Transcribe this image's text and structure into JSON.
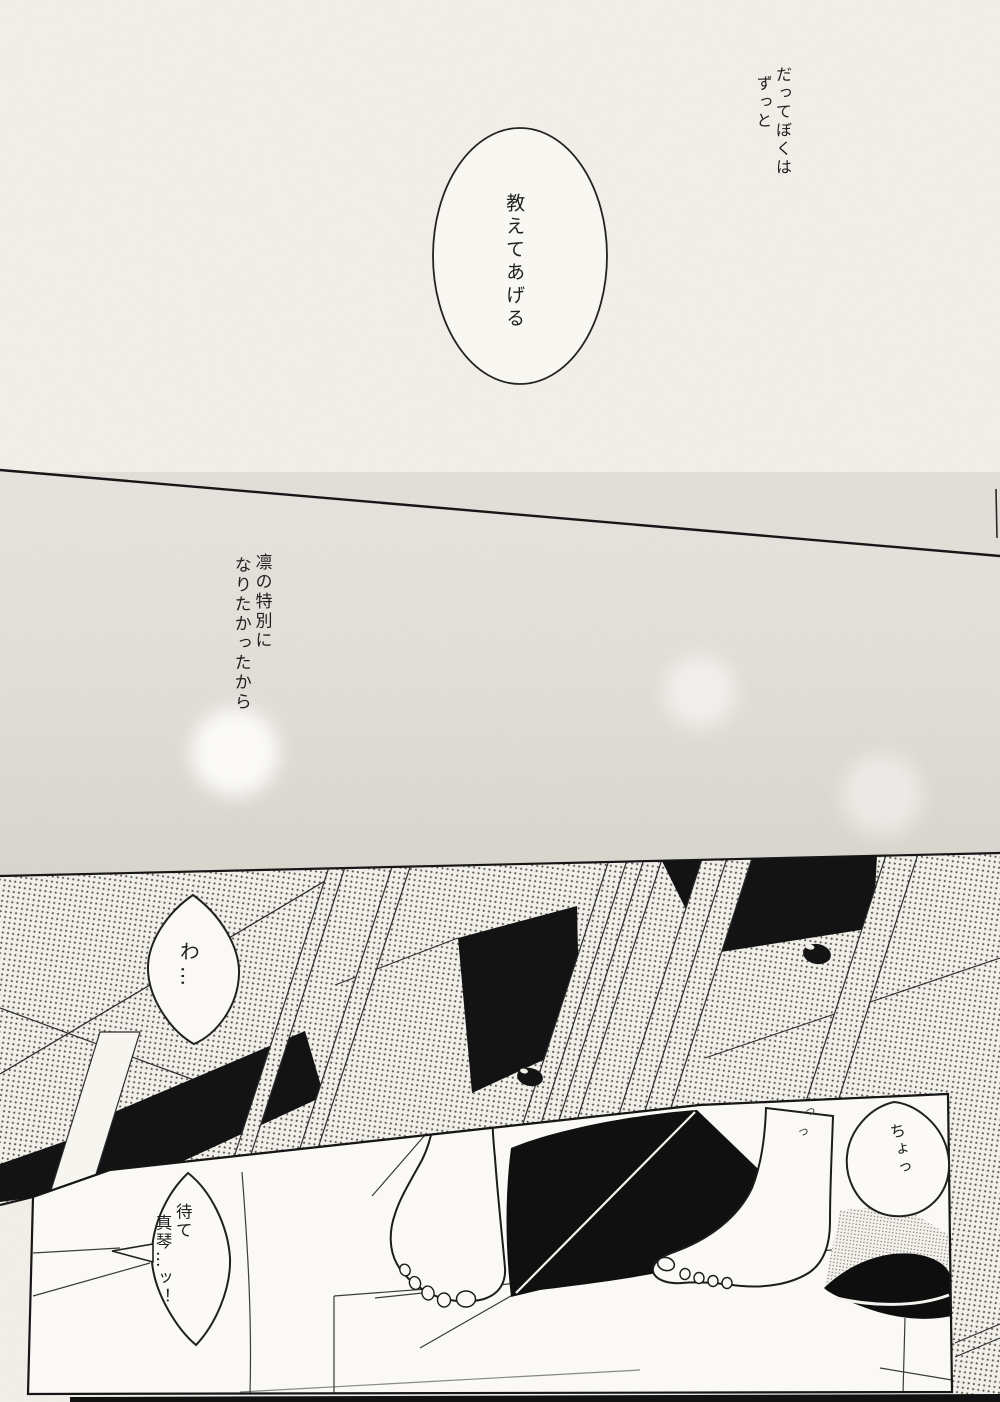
{
  "page": {
    "narration_top": {
      "line1": "だってぼくは",
      "line2": "ずっと"
    },
    "bubble_teach": {
      "text": "教えてあげる"
    },
    "narration_mid": {
      "line1": "凛の特別に",
      "line2": "なりたかったから"
    },
    "bubble_wa": {
      "text": "わ…"
    },
    "bubble_cho": {
      "text": "ちょっ"
    },
    "bubble_mate": {
      "line1": "待て",
      "line2": "真琴…ッ！"
    },
    "sfx": {
      "mark1": "っ",
      "mark2": "っ"
    },
    "colors": {
      "paper": "#f5f2ec",
      "panel_floor": "#fbf9f5",
      "ink": "#1c1c1c",
      "tone_base": "#f1efe9",
      "tone_dot": "#57524b",
      "speckle_dark": "#e5e2da"
    }
  }
}
